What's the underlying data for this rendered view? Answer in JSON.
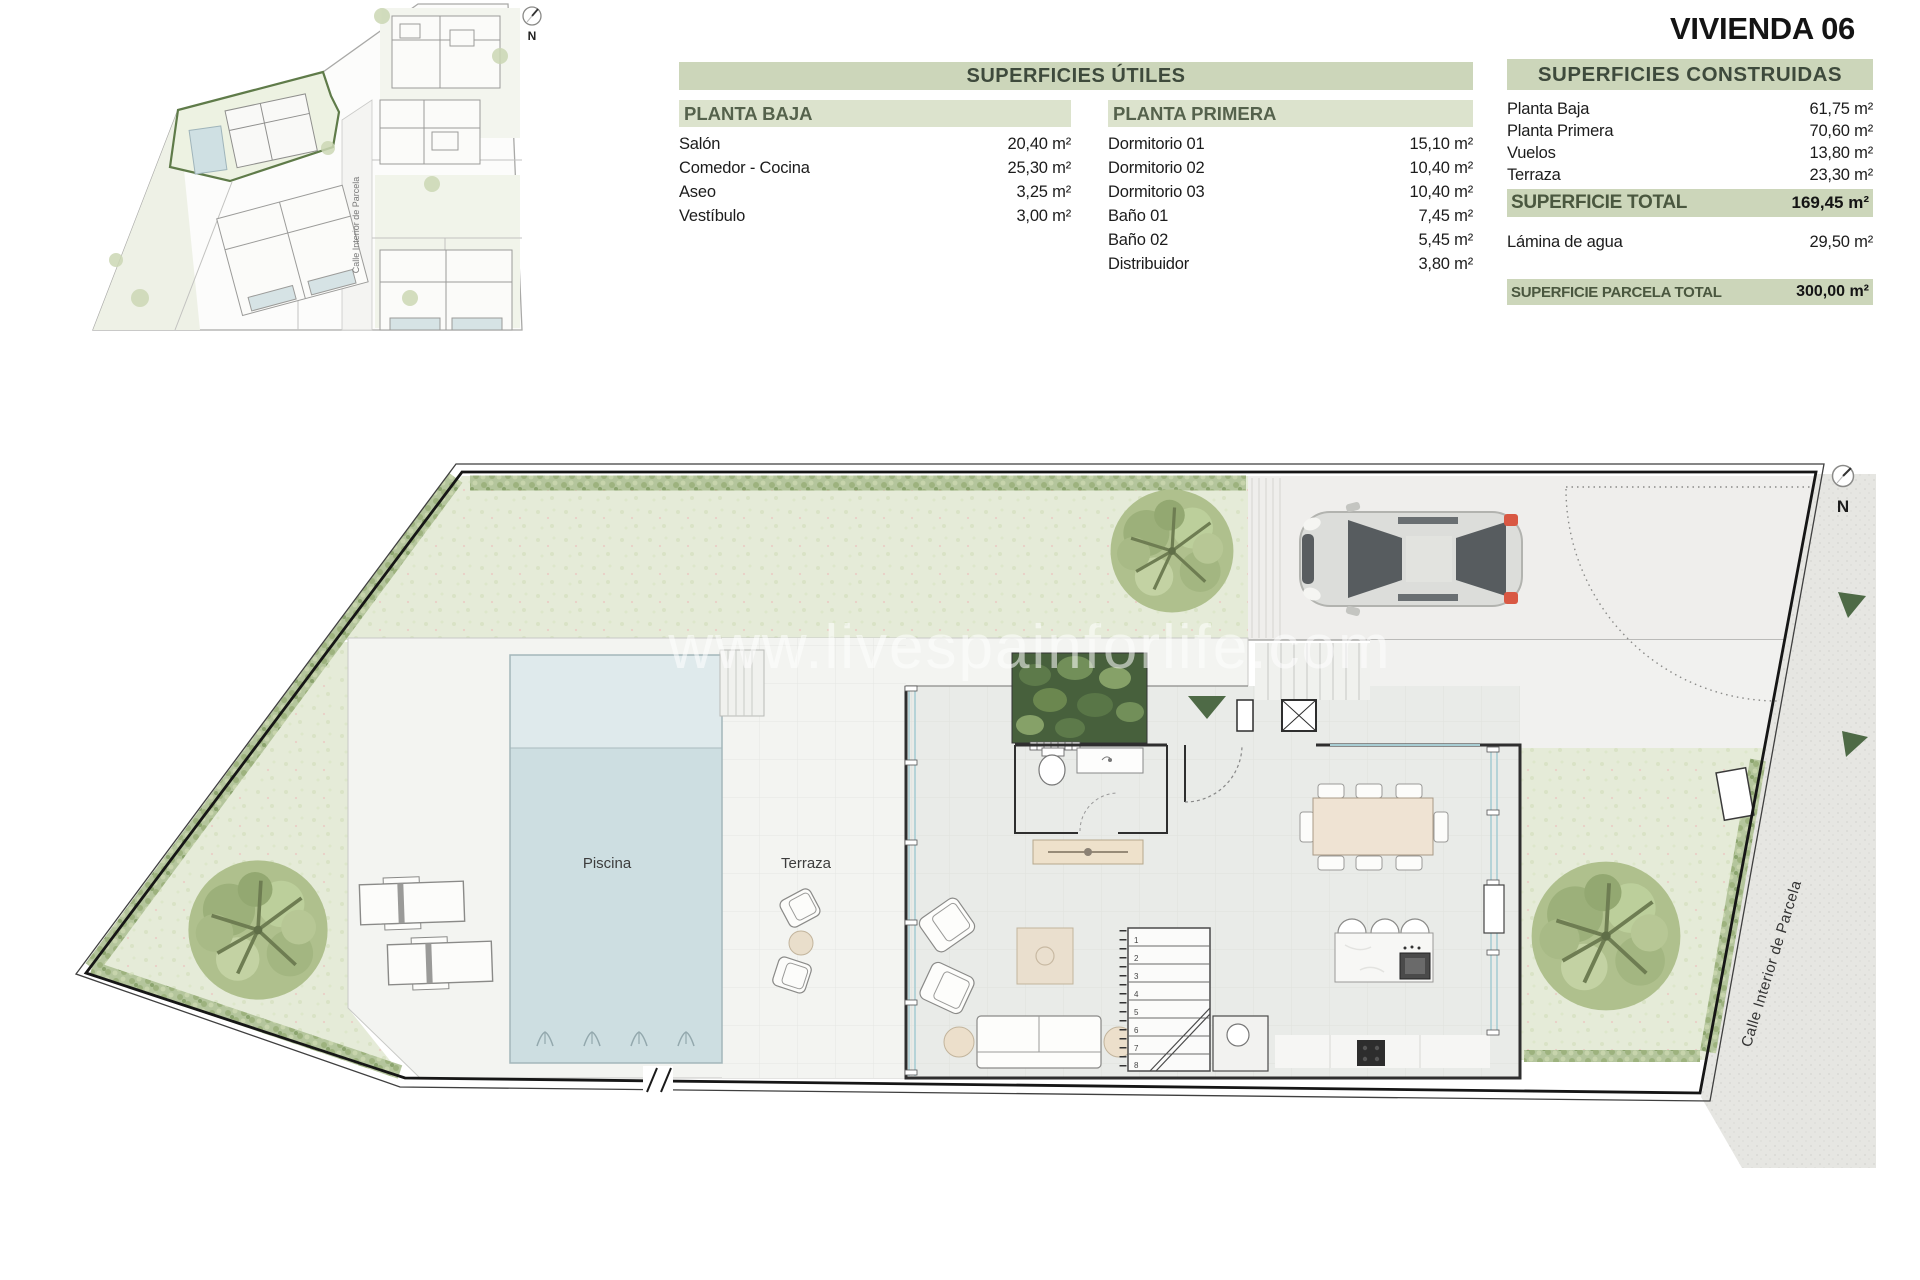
{
  "title": "VIVIENDA 06",
  "site_plan": {
    "street_label": "Calle Interior de Parcela",
    "north_label": "N"
  },
  "tables": {
    "utiles": {
      "header": "SUPERFICIES ÚTILES",
      "planta_baja": {
        "header": "PLANTA BAJA",
        "rows": [
          {
            "label": "Salón",
            "value": "20,40 m²"
          },
          {
            "label": "Comedor - Cocina",
            "value": "25,30 m²"
          },
          {
            "label": "Aseo",
            "value": "3,25 m²"
          },
          {
            "label": "Vestíbulo",
            "value": "3,00 m²"
          }
        ]
      },
      "planta_primera": {
        "header": "PLANTA PRIMERA",
        "rows": [
          {
            "label": "Dormitorio 01",
            "value": "15,10 m²"
          },
          {
            "label": "Dormitorio 02",
            "value": "10,40 m²"
          },
          {
            "label": "Dormitorio 03",
            "value": "10,40 m²"
          },
          {
            "label": "Baño 01",
            "value": "7,45 m²"
          },
          {
            "label": "Baño 02",
            "value": "5,45 m²"
          },
          {
            "label": "Distribuidor",
            "value": "3,80 m²"
          }
        ]
      }
    },
    "construidas": {
      "header": "SUPERFICIES CONSTRUIDAS",
      "rows": [
        {
          "label": "Planta Baja",
          "value": "61,75 m²"
        },
        {
          "label": "Planta Primera",
          "value": "70,60 m²"
        },
        {
          "label": "Vuelos",
          "value": "13,80 m²"
        },
        {
          "label": "Terraza",
          "value": "23,30 m²"
        }
      ],
      "total": {
        "label": "SUPERFICIE TOTAL",
        "value": "169,45 m²"
      },
      "water": {
        "label": "Lámina de agua",
        "value": "29,50 m²"
      },
      "parcel": {
        "label": "SUPERFICIE PARCELA TOTAL",
        "value": "300,00 m²"
      }
    }
  },
  "floor_plan": {
    "pool_label": "Piscina",
    "terrace_label": "Terraza",
    "street_label": "Calle Interior de Parcela",
    "north_label": "N",
    "watermark": "www.livespainforlife.com",
    "stair_numbers": [
      "1",
      "2",
      "3",
      "4",
      "5",
      "6",
      "7",
      "8"
    ]
  },
  "colors": {
    "table_band_green": "#ccd6ba",
    "table_subband_green": "#dce3cd",
    "band_text_green": "#4a573f",
    "highlight_parcel_green": "#5f7b49",
    "lawn_green": "#e5ebd8",
    "hedge_green": "#b4c59c",
    "tree_green": "#afc08d",
    "pool_blue": "#cddee1",
    "accent_dark_green": "#4e6a46",
    "taillight_red": "#d95843"
  }
}
